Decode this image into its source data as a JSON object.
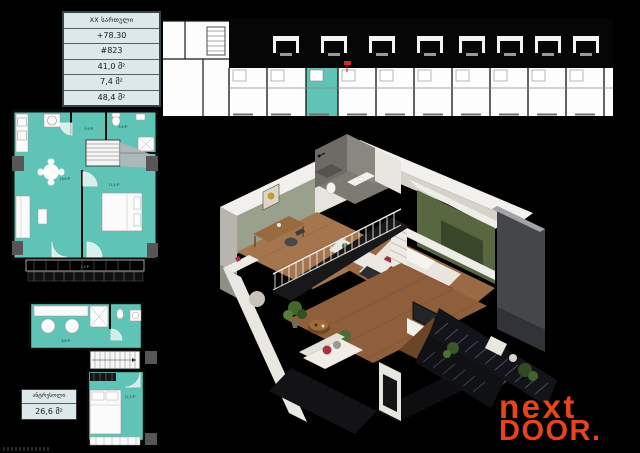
{
  "info_table": {
    "rows": [
      "XX სართული",
      "+78.30",
      "#823",
      "41,0 მ²",
      "7,4 მ²",
      "48,4 მ²"
    ]
  },
  "main_plan": {
    "labels": {
      "living": "19,6 მ²",
      "hall": "5,6 მ²",
      "bath": "3,6 მ²",
      "bedroom": "11,4 მ²",
      "balcony": "7,4 მ²"
    }
  },
  "mezzanine_plan": {
    "labels": {
      "bath": "8,8 მ²",
      "bedroom": "11,2 მ²"
    }
  },
  "mezzanine_label": {
    "title": "ანტრესოლი",
    "area": "26,6 მ²"
  },
  "logo": {
    "line1": "next",
    "line2": "DOOR."
  },
  "colors": {
    "highlight_teal": "#5fc3b5",
    "table_bg": "#dde8eb",
    "logo_orange": "#e8431b",
    "bed_red": "#a02c39",
    "accent_green": "#58673f",
    "wood_floor": "#96653f"
  }
}
